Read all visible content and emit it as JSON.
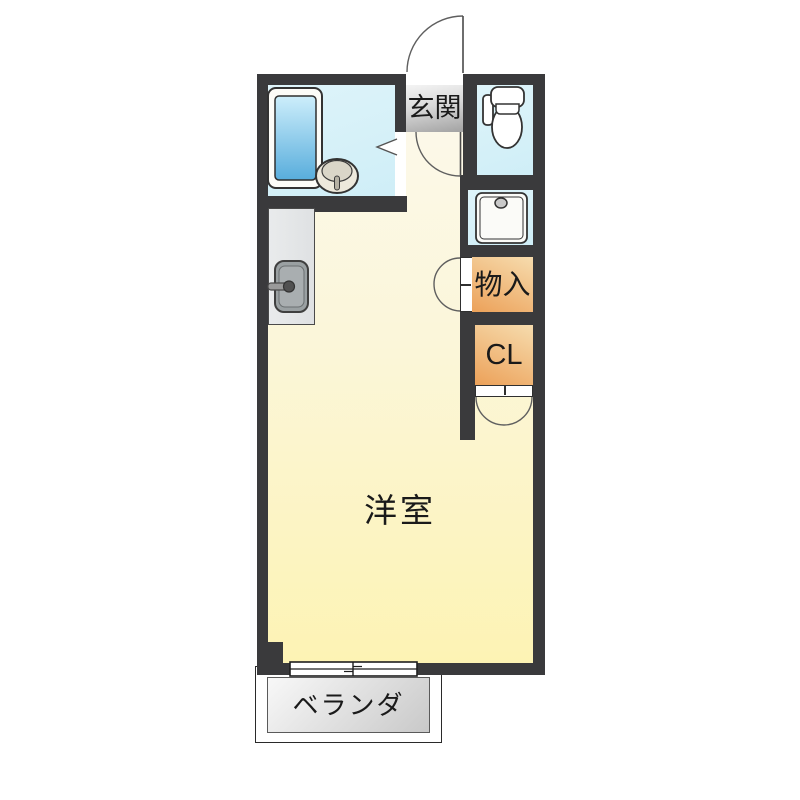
{
  "title": "1R apartment floor plan",
  "labels": {
    "entrance": "玄関",
    "western_room": "洋室",
    "storage": "物入",
    "closet": "CL",
    "veranda": "ベランダ"
  },
  "fixtures": [
    "bathtub-icon",
    "washbasin-icon",
    "toilet-icon",
    "washing-machine-pan-icon",
    "kitchen-sink-icon",
    "entrance-door-swing-icon",
    "hall-door-swing-icon",
    "bathroom-folding-door-icon",
    "storage-double-door-icon",
    "closet-double-door-icon",
    "sliding-window-icon"
  ],
  "colors": {
    "wall": "#3a3a3c",
    "water_room": "#d7f0f7",
    "floor_top": "#fcf9ec",
    "floor_bottom": "#fdf3b4",
    "closet_light": "#f6dcae",
    "closet_dark": "#eca159",
    "entrance_light": "#f4f4f4",
    "entrance_dark": "#a2a2a2",
    "bathtub_light": "#cdeefb",
    "bathtub_dark": "#58addc",
    "veranda_light": "#f8f8f8",
    "veranda_dark": "#c9c9c9"
  }
}
